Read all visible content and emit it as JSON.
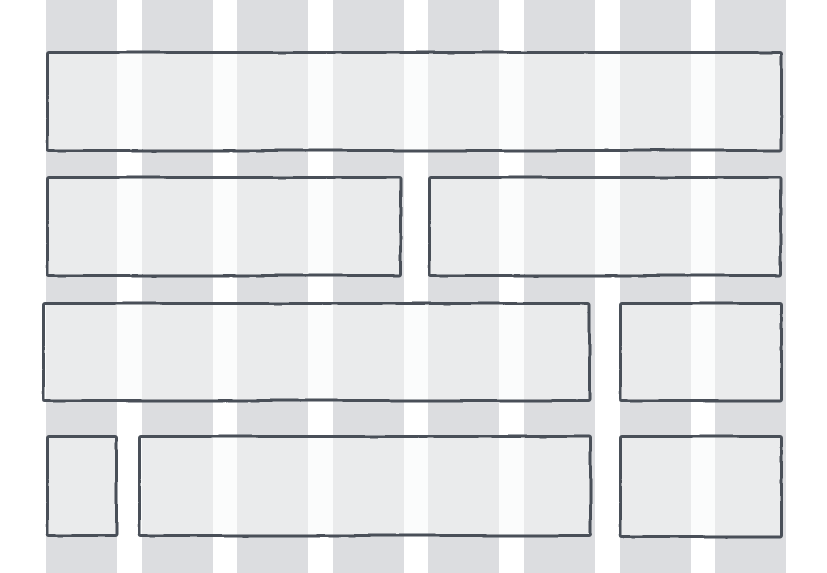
{
  "canvas": {
    "width": 827,
    "height": 573,
    "background_color": "#ffffff"
  },
  "grid": {
    "columns": 8,
    "left_margin": 46,
    "stripe_width": 71,
    "gutter": 24.6,
    "stripe_color": "#dcdde0"
  },
  "box_style": {
    "stroke_color": "#4a5058",
    "stroke_width": 3,
    "fill_color": "rgba(248,249,250,0.5)",
    "corner_radius": 3
  },
  "boxes": [
    {
      "name": "header",
      "x": 46,
      "y": 51,
      "w": 737,
      "h": 101
    },
    {
      "name": "section-left",
      "x": 46,
      "y": 176,
      "w": 356,
      "h": 101
    },
    {
      "name": "section-right",
      "x": 428,
      "y": 176,
      "w": 354,
      "h": 101
    },
    {
      "name": "content-main",
      "x": 42,
      "y": 302,
      "w": 549,
      "h": 100
    },
    {
      "name": "sidebar-top",
      "x": 619,
      "y": 302,
      "w": 164,
      "h": 100
    },
    {
      "name": "avatar",
      "x": 46,
      "y": 435,
      "w": 72,
      "h": 102
    },
    {
      "name": "content-bottom",
      "x": 138,
      "y": 435,
      "w": 454,
      "h": 102
    },
    {
      "name": "sidebar-bottom",
      "x": 619,
      "y": 435,
      "w": 164,
      "h": 103
    }
  ]
}
